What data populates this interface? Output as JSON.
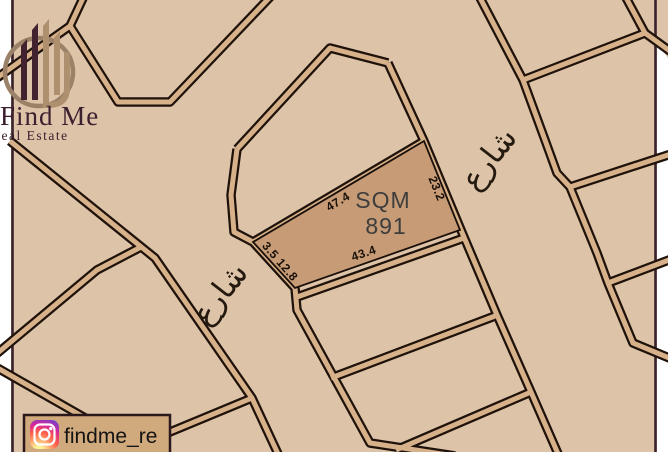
{
  "branding": {
    "title": "Find Me",
    "subtitle": "Real Estate"
  },
  "social": {
    "platform": "instagram",
    "handle": "findme_re"
  },
  "plot": {
    "area_label": "SQM",
    "area_value": "891",
    "dims": {
      "top": "47.4",
      "right": "23.2",
      "bottom": "43.4",
      "left": "3.5 12.8"
    }
  },
  "streets": {
    "left_label": "شارع",
    "right_label": "شارع"
  },
  "colors": {
    "map_background": "#ddc3a7",
    "road_fill": "#d7b189",
    "road_casing": "#1e120b",
    "highlighted_plot_fill": "#c69b76",
    "page_margin": "#ffffff",
    "border_line": "#3a222b",
    "logo_dark": "#42222e",
    "logo_tan": "#ae8f6e",
    "text_dark": "#181008"
  }
}
